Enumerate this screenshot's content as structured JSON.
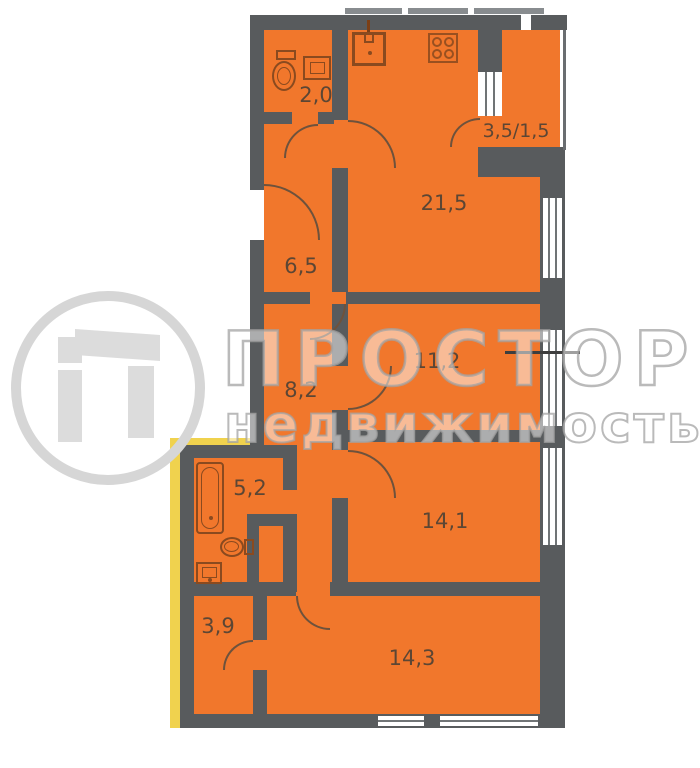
{
  "watermark": {
    "title": "ПРОСТОР",
    "subtitle": "недвижимость"
  },
  "rooms": {
    "wc": {
      "label": "2,0"
    },
    "balcony": {
      "label": "3,5/1,5"
    },
    "kitchen_living": {
      "label": "21,5"
    },
    "hallway": {
      "label": "6,5"
    },
    "room11": {
      "label": "11,2"
    },
    "corridor": {
      "label": "8,2"
    },
    "bathroom": {
      "label": "5,2"
    },
    "room141": {
      "label": "14,1"
    },
    "wardrobe": {
      "label": "3,9"
    },
    "room143": {
      "label": "14,3"
    }
  },
  "colors": {
    "room_fill": "#f1772c",
    "wall": "#585b5d",
    "highlight_yellow": "#f0d24e",
    "label_text": "#5c4634",
    "fixture_outline": "#8a4a1f",
    "watermark_gray": "#d6d6d6"
  }
}
